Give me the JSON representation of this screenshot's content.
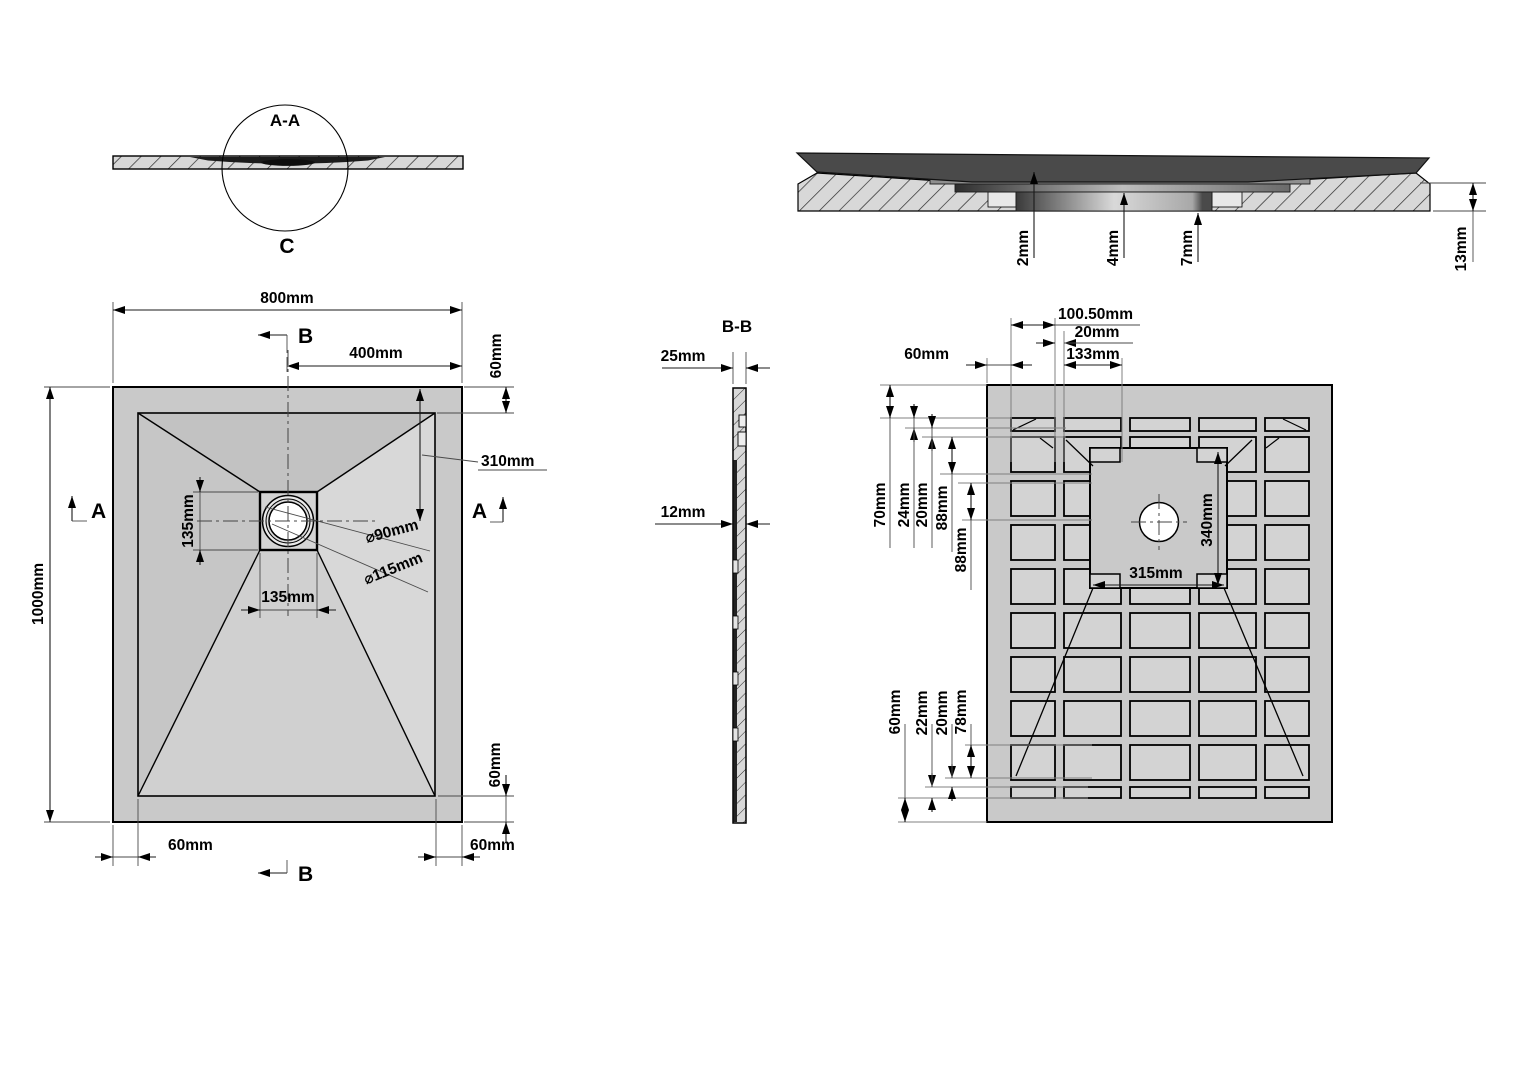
{
  "section_aa": {
    "title": "A-A",
    "detail_label": "C"
  },
  "detail_c": {
    "step1": "2mm",
    "step2": "4mm",
    "step3": "7mm",
    "thickness": "13mm"
  },
  "plan": {
    "width": "800mm",
    "height": "1000mm",
    "center_to_edge": "400mm",
    "rim_top": "60mm",
    "drain_offset": "310mm",
    "drain_square_h": "135mm",
    "drain_square_w": "135mm",
    "drain_inner_dia": "⌀90mm",
    "drain_outer_dia": "⌀115mm",
    "rim_bottom_left": "60mm",
    "rim_bottom_right": "60mm",
    "rim_bottom": "60mm",
    "marker_a_left": "A",
    "marker_a_right": "A",
    "marker_b_top": "B",
    "marker_b_bottom": "B"
  },
  "section_bb": {
    "title": "B-B",
    "thickness_top": "25mm",
    "thickness_mid": "12mm"
  },
  "bottom_view": {
    "rim_left": "60mm",
    "pocket_offset": "100.50mm",
    "web_width": "20mm",
    "pocket_width": "133mm",
    "v_70": "70mm",
    "v_24": "24mm",
    "v_20": "20mm",
    "v_88a": "88mm",
    "v_88b": "88mm",
    "center_width": "315mm",
    "center_height": "340mm",
    "b_78": "78mm",
    "b_20": "20mm",
    "b_22": "22mm",
    "b_60": "60mm"
  }
}
